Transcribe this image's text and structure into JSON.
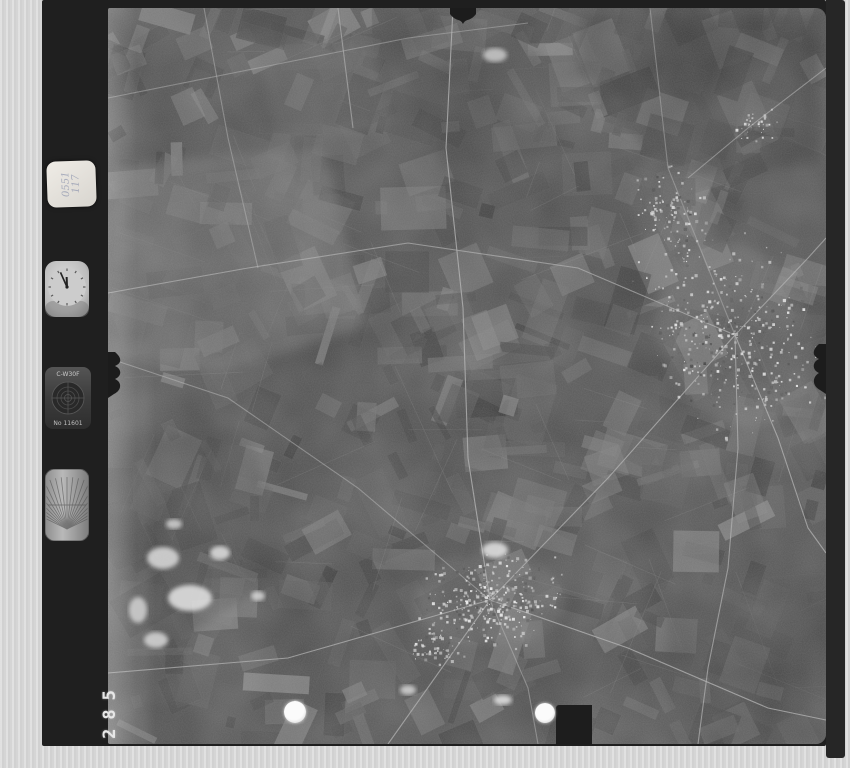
{
  "scan": {
    "description": "Black-and-white vertical aerial survey photograph (film frame scan) of agricultural field mosaic with two bright towns, roads radiating from each, film data strip on left with recording instruments",
    "frame_number": "285",
    "label": {
      "line1": "0551",
      "line2": "117"
    },
    "instruments": {
      "clock": {
        "name": "mission clock",
        "time": "11:56"
      },
      "data_plate": {
        "top_text": "C-W30F",
        "bottom_text": "No 11601"
      },
      "level_gauge": {
        "name": "graduated fan scale"
      }
    },
    "markers": {
      "left_dot": "punched control point",
      "right_dot": "punched control point"
    }
  },
  "colors": {
    "scan_background": "#d5d5d5",
    "film_border": "#1f1f1f",
    "photo_base": "#484848",
    "road": "#b5b5b5",
    "town_speck_light": "#dedede",
    "dot": "#fbfbfb"
  },
  "photo_render": {
    "seed": 1337,
    "width": 718,
    "height": 736,
    "palette": [
      "#2f2f2f",
      "#383838",
      "#424242",
      "#4c4c4c",
      "#565656",
      "#616161",
      "#6d6d6d",
      "#797979",
      "#868686"
    ],
    "field_count": 540,
    "boundary_count": 70,
    "angles": [
      -24,
      66,
      20,
      -70,
      0
    ],
    "regions": [
      {
        "points": "5,160 215,138 258,318 120,362 5,352",
        "fill": "#6e6e6e",
        "op": 0.55
      },
      {
        "points": "150,42 262,26 282,118 172,140",
        "fill": "#646464",
        "op": 0.4
      },
      {
        "points": "470,8 712,8 712,158 560,170 470,62",
        "fill": "#343434",
        "op": 0.5
      },
      {
        "points": "300,62 432,42 452,140 332,162",
        "fill": "#3b3b3b",
        "op": 0.45
      },
      {
        "points": "0,430 140,420 182,560 62,640 0,600",
        "fill": "#3a3a3a",
        "op": 0.4
      },
      {
        "points": "560,600 718,560 718,736 560,736",
        "fill": "#414141",
        "op": 0.45
      },
      {
        "points": "0,330 42,335 40,736 0,736",
        "fill": "#757575",
        "op": 0.35
      },
      {
        "points": "640,380 718,360 718,470 660,460",
        "fill": "#585858",
        "op": 0.4
      }
    ],
    "halos": [
      {
        "cx": 627,
        "cy": 327,
        "rx": 75,
        "ry": 95,
        "rot": -25,
        "fill": "#777777",
        "op": 0.3
      },
      {
        "cx": 382,
        "cy": 592,
        "rx": 75,
        "ry": 46,
        "rot": 0,
        "fill": "#777777",
        "op": 0.3
      },
      {
        "cx": 565,
        "cy": 205,
        "rx": 40,
        "ry": 60,
        "rot": -20,
        "fill": "#6e6e6e",
        "op": 0.25
      }
    ],
    "roads": [
      [
        [
          0,
          350
        ],
        [
          120,
          390
        ],
        [
          250,
          480
        ],
        [
          382,
          592
        ]
      ],
      [
        [
          382,
          592
        ],
        [
          500,
          470
        ],
        [
          627,
          327
        ]
      ],
      [
        [
          627,
          327
        ],
        [
          560,
          160
        ],
        [
          542,
          0
        ]
      ],
      [
        [
          627,
          327
        ],
        [
          700,
          250
        ],
        [
          718,
          230
        ]
      ],
      [
        [
          627,
          327
        ],
        [
          670,
          430
        ],
        [
          700,
          520
        ],
        [
          718,
          545
        ]
      ],
      [
        [
          627,
          327
        ],
        [
          470,
          260
        ],
        [
          300,
          235
        ],
        [
          140,
          260
        ],
        [
          0,
          285
        ]
      ],
      [
        [
          382,
          592
        ],
        [
          280,
          736
        ]
      ],
      [
        [
          382,
          592
        ],
        [
          420,
          680
        ],
        [
          430,
          736
        ]
      ],
      [
        [
          382,
          592
        ],
        [
          180,
          650
        ],
        [
          0,
          665
        ]
      ],
      [
        [
          382,
          592
        ],
        [
          520,
          640
        ],
        [
          660,
          700
        ],
        [
          718,
          712
        ]
      ],
      [
        [
          382,
          592
        ],
        [
          360,
          450
        ],
        [
          355,
          300
        ],
        [
          338,
          140
        ],
        [
          345,
          0
        ]
      ],
      [
        [
          0,
          90
        ],
        [
          150,
          60
        ],
        [
          300,
          30
        ],
        [
          420,
          15
        ]
      ],
      [
        [
          96,
          0
        ],
        [
          120,
          130
        ],
        [
          150,
          260
        ]
      ],
      [
        [
          230,
          0
        ],
        [
          245,
          120
        ]
      ],
      [
        [
          627,
          327
        ],
        [
          630,
          440
        ],
        [
          620,
          560
        ],
        [
          600,
          660
        ],
        [
          590,
          736
        ]
      ],
      [
        [
          718,
          60
        ],
        [
          640,
          120
        ],
        [
          580,
          170
        ]
      ]
    ],
    "towns": [
      {
        "cx": 627,
        "cy": 327,
        "sx": 85,
        "sy": 110,
        "rot": -25,
        "n": 430
      },
      {
        "cx": 565,
        "cy": 205,
        "sx": 35,
        "sy": 55,
        "rot": -20,
        "n": 110
      },
      {
        "cx": 647,
        "cy": 118,
        "sx": 25,
        "sy": 18,
        "rot": 0,
        "n": 45
      },
      {
        "cx": 382,
        "cy": 592,
        "sx": 80,
        "sy": 52,
        "rot": 0,
        "n": 330
      },
      {
        "cx": 330,
        "cy": 640,
        "sx": 30,
        "sy": 20,
        "rot": 20,
        "n": 60
      }
    ],
    "patches": [
      [
        55,
        550,
        16,
        11
      ],
      [
        82,
        590,
        22,
        13
      ],
      [
        48,
        632,
        12,
        8
      ],
      [
        112,
        545,
        10,
        7
      ],
      [
        30,
        602,
        9,
        13
      ],
      [
        387,
        542,
        13,
        8
      ],
      [
        387,
        47,
        12,
        7
      ],
      [
        300,
        682,
        8,
        5
      ],
      [
        395,
        692,
        9,
        5
      ],
      [
        150,
        588,
        7,
        5
      ],
      [
        66,
        516,
        8,
        5
      ]
    ]
  }
}
